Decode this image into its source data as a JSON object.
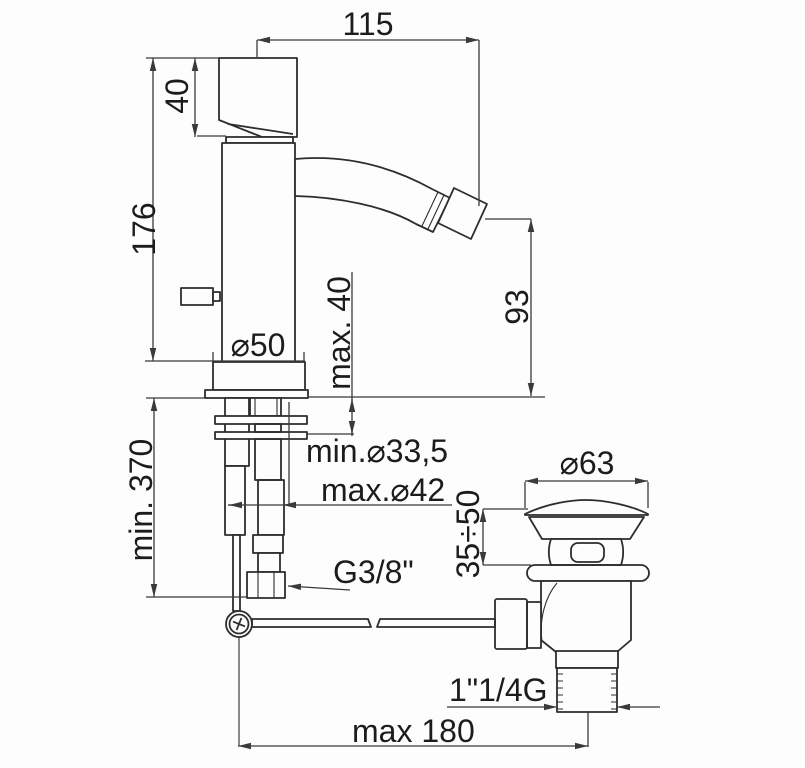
{
  "drawing": {
    "type": "technical-dimension-drawing",
    "subject": "single-lever bidet mixer with pop-up waste, side view",
    "ink_color": "#2d2d2d",
    "background_color": "#fdfdfd",
    "labels": {
      "spout_reach": "115",
      "handle_height": "40",
      "body_height": "176",
      "base_diameter": "⌀50",
      "max_deck_thickness": "max. 40",
      "spout_height": "93",
      "min_clearance_below": "min. 370",
      "min_hole_diameter": "min.⌀33,5",
      "max_hole_diameter": "max.⌀42",
      "supply_thread": "G3/8\"",
      "waste_cap_diameter": "⌀63",
      "plug_adjust_range": "35÷50",
      "waste_thread": "1\"1/4G",
      "max_rod_distance": "max 180"
    }
  }
}
